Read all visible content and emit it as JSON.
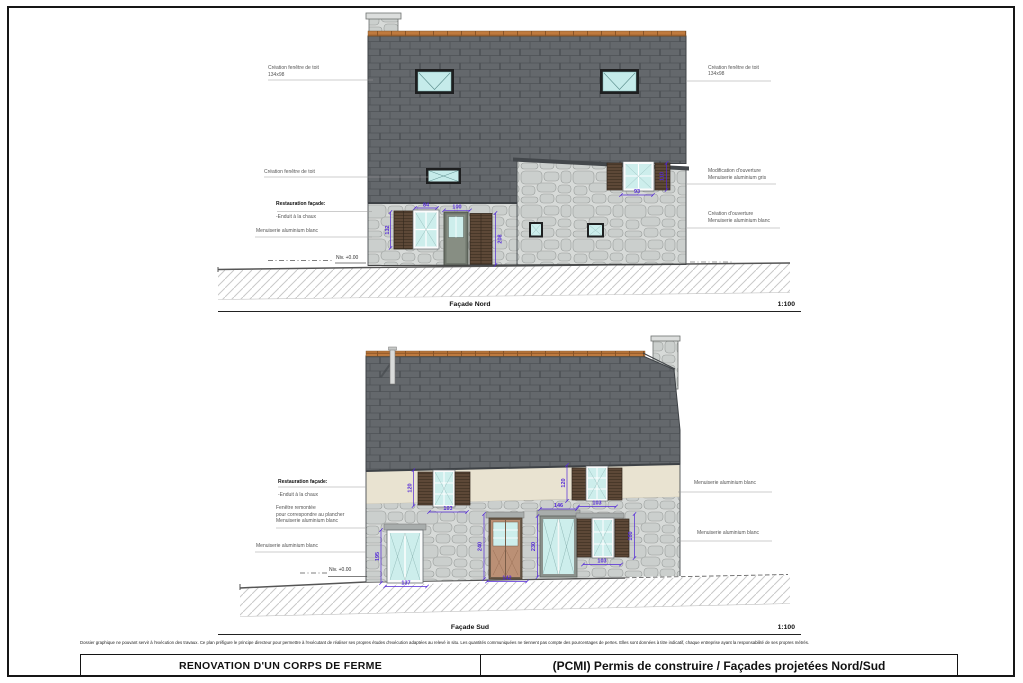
{
  "sheet": {
    "disclaimer": "Dossier graphique ne pouvant servir à l'exécution des travaux. Ce plan préfigure le principe directeur pour permettre à l'exécutant de réaliser ses propres études d'exécution adaptées au relevé in situ.  Les quantités communiquées ne tiennent pas compte des pourcentages de pertes. Elles sont données à titre indicatif, chaque entreprise ayant la responsabilité de ses propres métrés.",
    "title_block": {
      "project_title": "RENOVATION D'UN CORPS DE FERME",
      "document_title": "(PCMI) Permis de construire / Façades projetées Nord/Sud"
    }
  },
  "facade_nord": {
    "caption": "Façade Nord",
    "scale": "1:100",
    "level_label": "Niv. +0.00",
    "labels_left": [
      {
        "text": "Création fenêtre de toit\n134x98"
      },
      {
        "text": "Création fenêtre de toit"
      },
      {
        "title": "Restauration façade:",
        "text": "-Enduit à la chaux"
      },
      {
        "text": "Menuiserie aluminium blanc"
      }
    ],
    "labels_right": [
      {
        "text": "Création fenêtre de toit\n134x98"
      },
      {
        "text": "Modification d'ouverture\nMenuiserie aluminium gris"
      },
      {
        "text": "Création d'ouverture\nMenuiserie aluminium blanc"
      }
    ],
    "dims": {
      "window_width": "84",
      "door_width": "100",
      "window_height": "132",
      "door_height": "208",
      "upper_window_width": "93",
      "upper_window_height": "110"
    }
  },
  "facade_sud": {
    "caption": "Façade Sud",
    "scale": "1:100",
    "level_label": "Niv. +0.00",
    "labels_left": [
      {
        "title": "Restauration façade:",
        "text": "-Enduit à la chaux"
      },
      {
        "text": "Fenêtre remontée\npour correspondre au plancher\nMenuiserie aluminium blanc"
      },
      {
        "text": "Menuiserie aluminium blanc"
      }
    ],
    "labels_right": [
      {
        "text": "Menuiserie aluminium blanc"
      },
      {
        "text": "Menuiserie aluminium blanc"
      }
    ],
    "dims": {
      "upper_window1_height": "120",
      "upper_window1_width": "103",
      "upper_window2_height": "120",
      "upper_window2_width": "103",
      "tall_window_height": "195",
      "tall_window_width": "137",
      "door_height": "240",
      "door_width": "142",
      "glazed_door_width": "146",
      "glazed_door_height": "230",
      "window_height": "160",
      "window_width": "103"
    }
  },
  "colors": {
    "dimension_accent": "#5328d8",
    "roof_slate": "#64686c",
    "ridge_tile": "#bf7a3e",
    "stone_wall": "#d7dad8",
    "lime_plaster": "#e9e3d1",
    "window_glass": "#cdeeec",
    "shutter_wood": "#5d4837"
  }
}
